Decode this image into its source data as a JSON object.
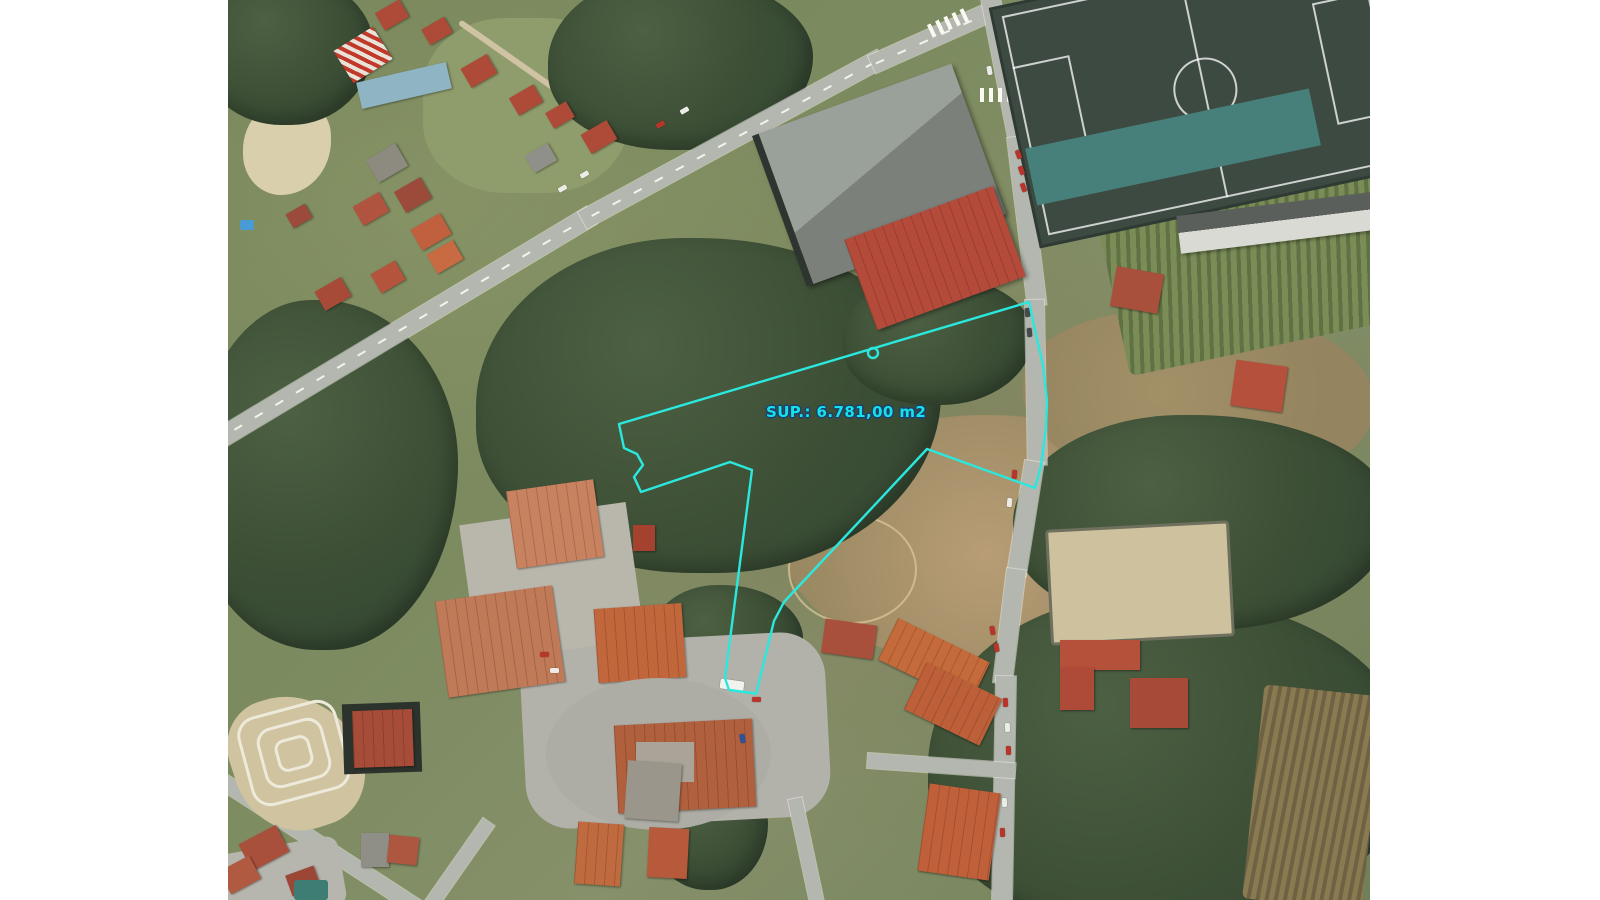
{
  "overlay": {
    "area_label": "SUP.: 6.781,00 m2",
    "outline_color": "#2be8de",
    "label_color": "#15e2e8",
    "label_outline_color": "#1d3f6e",
    "polygon_points": "391,424 396,448 409,454 415,465 406,477 413,492 502,462 524,470 497,678 501,690 524,693 528,694 546,621 556,602 699,449 807,488 813,466 818,427 819,401 815,365 808,335 801,302",
    "marker": {
      "cx": "645",
      "cy": "353",
      "r": "5"
    }
  }
}
